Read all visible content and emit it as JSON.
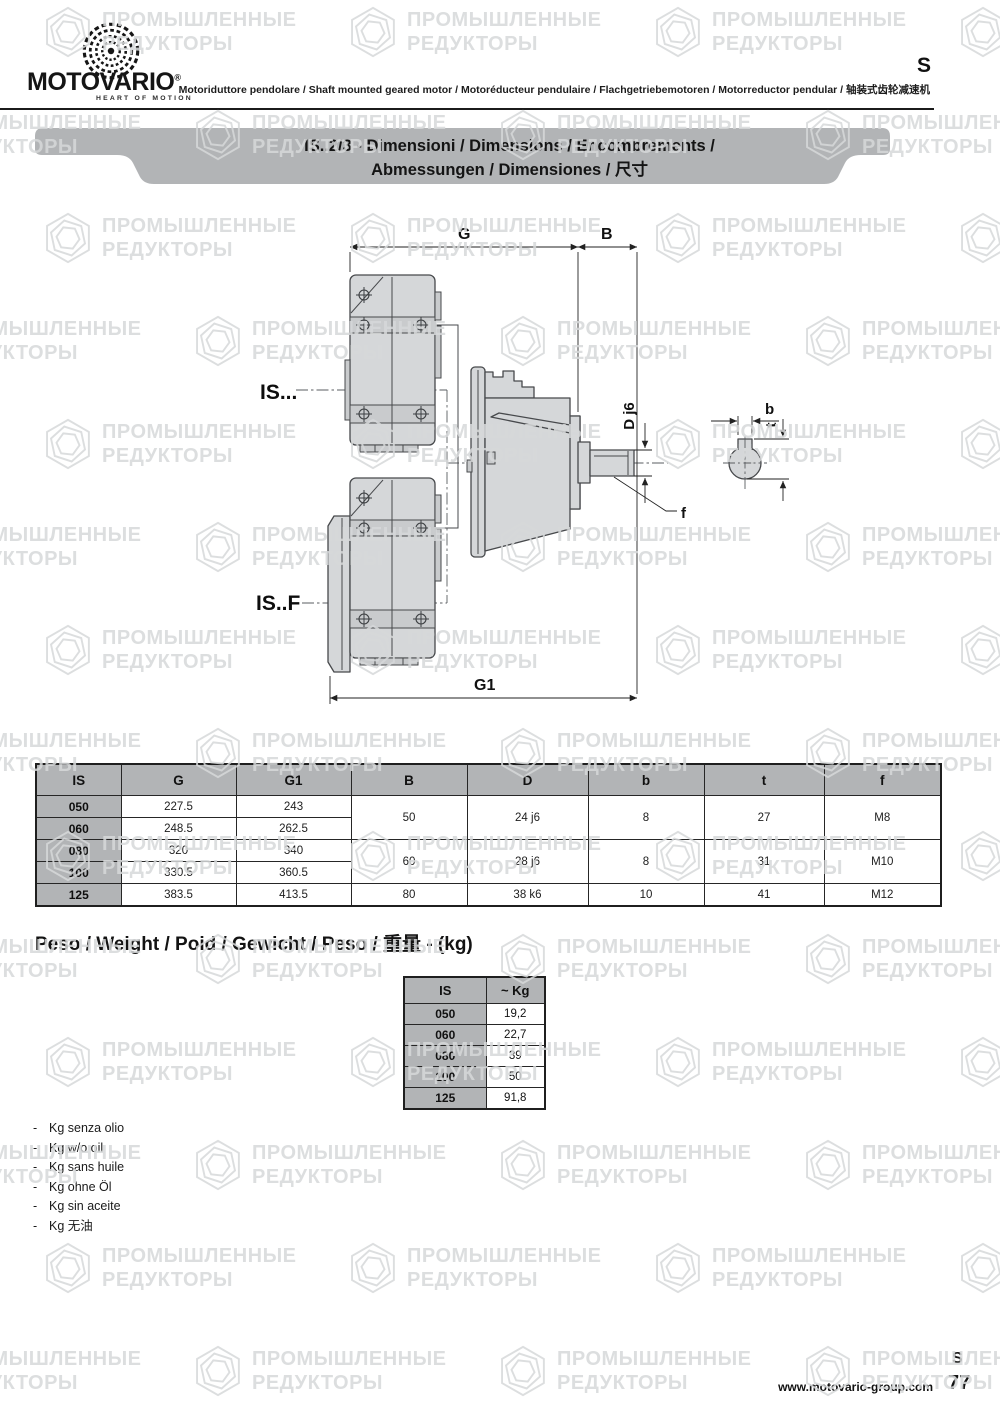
{
  "header": {
    "logo_text": "MOTOVARIO",
    "logo_reg": "®",
    "tagline": "HEART OF MOTION",
    "subtitle": "Motoriduttore pendolare / Shaft mounted geared motor / Motoréducteur pendulaire / Flachgetriebemotoren / Motorreductor pendular / 轴装式齿轮减速机",
    "corner_mark": "S"
  },
  "banner": {
    "line1": "IS..2/3 - Dimensioni / Dimensions / Encombrements /",
    "line2": "Abmessungen / Dimensiones / 尺寸"
  },
  "drawing": {
    "labels": {
      "g": "G",
      "b_dim": "B",
      "g1": "G1",
      "d_shaft": "D j6",
      "key_b": "b",
      "key_t": "t",
      "f": "f",
      "is_top": "IS...",
      "is_flange": "IS..F"
    }
  },
  "dim_table": {
    "headers": [
      "IS",
      "G",
      "G1",
      "B",
      "D",
      "b",
      "t",
      "f"
    ],
    "rows": [
      {
        "is": "050",
        "g": "227.5",
        "g1": "243"
      },
      {
        "is": "060",
        "g": "248.5",
        "g1": "262.5"
      },
      {
        "is": "080",
        "g": "320",
        "g1": "340"
      },
      {
        "is": "100",
        "g": "330.5",
        "g1": "360.5"
      },
      {
        "is": "125",
        "g": "383.5",
        "g1": "413.5"
      }
    ],
    "merged": [
      {
        "b": "50",
        "d": "24 j6",
        "kb": "8",
        "t": "27",
        "f": "M8"
      },
      {
        "b": "60",
        "d": "28 j6",
        "kb": "8",
        "t": "31",
        "f": "M10"
      },
      {
        "b": "80",
        "d": "38 k6",
        "kb": "10",
        "t": "41",
        "f": "M12"
      }
    ]
  },
  "weight": {
    "heading": "Peso / Weight / Poid / Gewicht / Peso / 重量 - (kg)",
    "headers": [
      "IS",
      "~ Kg"
    ],
    "rows": [
      [
        "050",
        "19,2"
      ],
      [
        "060",
        "22,7"
      ],
      [
        "080",
        "39"
      ],
      [
        "100",
        "50"
      ],
      [
        "125",
        "91,8"
      ]
    ]
  },
  "notes": {
    "bullet": "-",
    "items": [
      "Kg senza olio",
      "Kg w/o oil",
      "Kg sans huile",
      "Kg ohne Öl",
      "Kg sin aceite",
      "Kg 无油"
    ]
  },
  "footer": {
    "url": "www.motovario-group.com",
    "section": "S",
    "page": "77"
  },
  "watermark": {
    "line1": "ПРОМЫШЛЕННЫЕ",
    "line2": "РЕДУКТОРЫ"
  },
  "colors": {
    "banner_gray": "#b2b4b6",
    "table_header_gray": "#b2b4b6",
    "drawing_fill": "#d5d7d9",
    "drawing_stroke": "#47494c",
    "watermark_gray": "#d7d9da"
  }
}
